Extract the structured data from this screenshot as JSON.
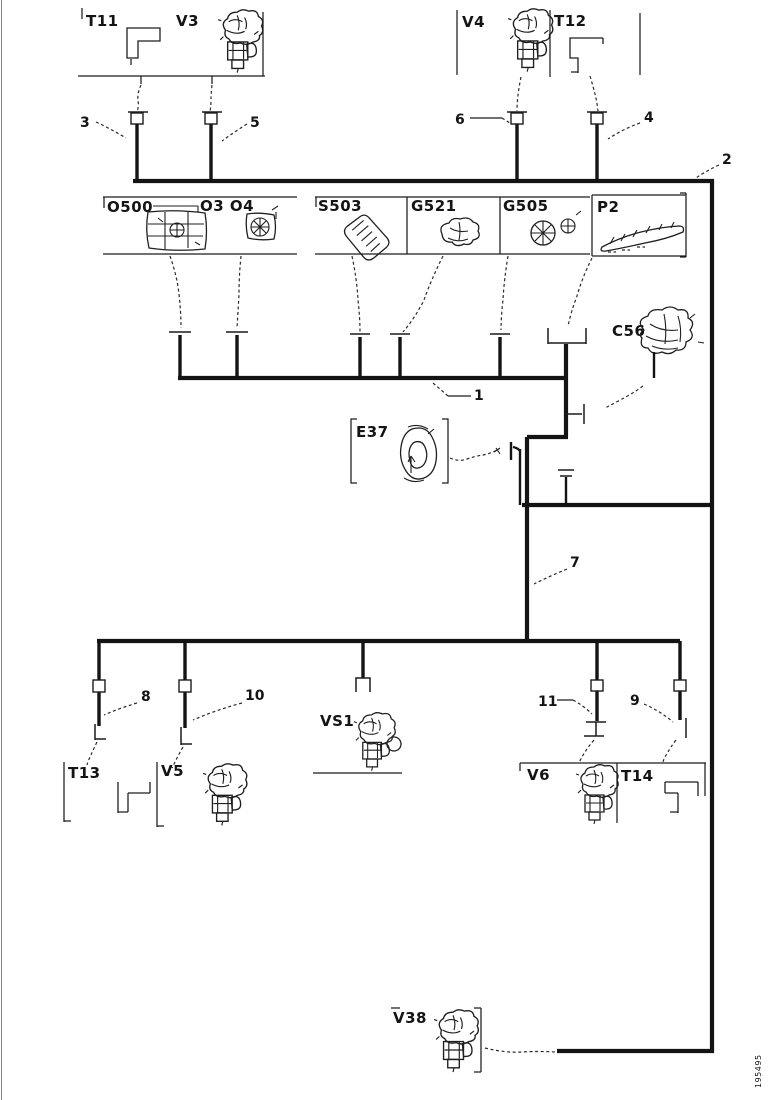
{
  "doc_number": "195495",
  "colors": {
    "line": "#141414",
    "background": "#ffffff"
  },
  "labels": {
    "t11": "T11",
    "v3": "V3",
    "v4": "V4",
    "t12": "T12",
    "o500": "O500",
    "o3o4": "O3 O4",
    "s503": "S503",
    "g521": "G521",
    "g505": "G505",
    "p2": "P2",
    "c56": "C56",
    "e37": "E37",
    "vs1": "VS1",
    "t13": "T13",
    "v5": "V5",
    "v6": "V6",
    "t14": "T14",
    "v38": "V38"
  },
  "wires": {
    "w1": "1",
    "w2": "2",
    "w3": "3",
    "w4": "4",
    "w5": "5",
    "w6": "6",
    "w7": "7",
    "w8": "8",
    "w9": "9",
    "w10": "10",
    "w11": "11"
  }
}
